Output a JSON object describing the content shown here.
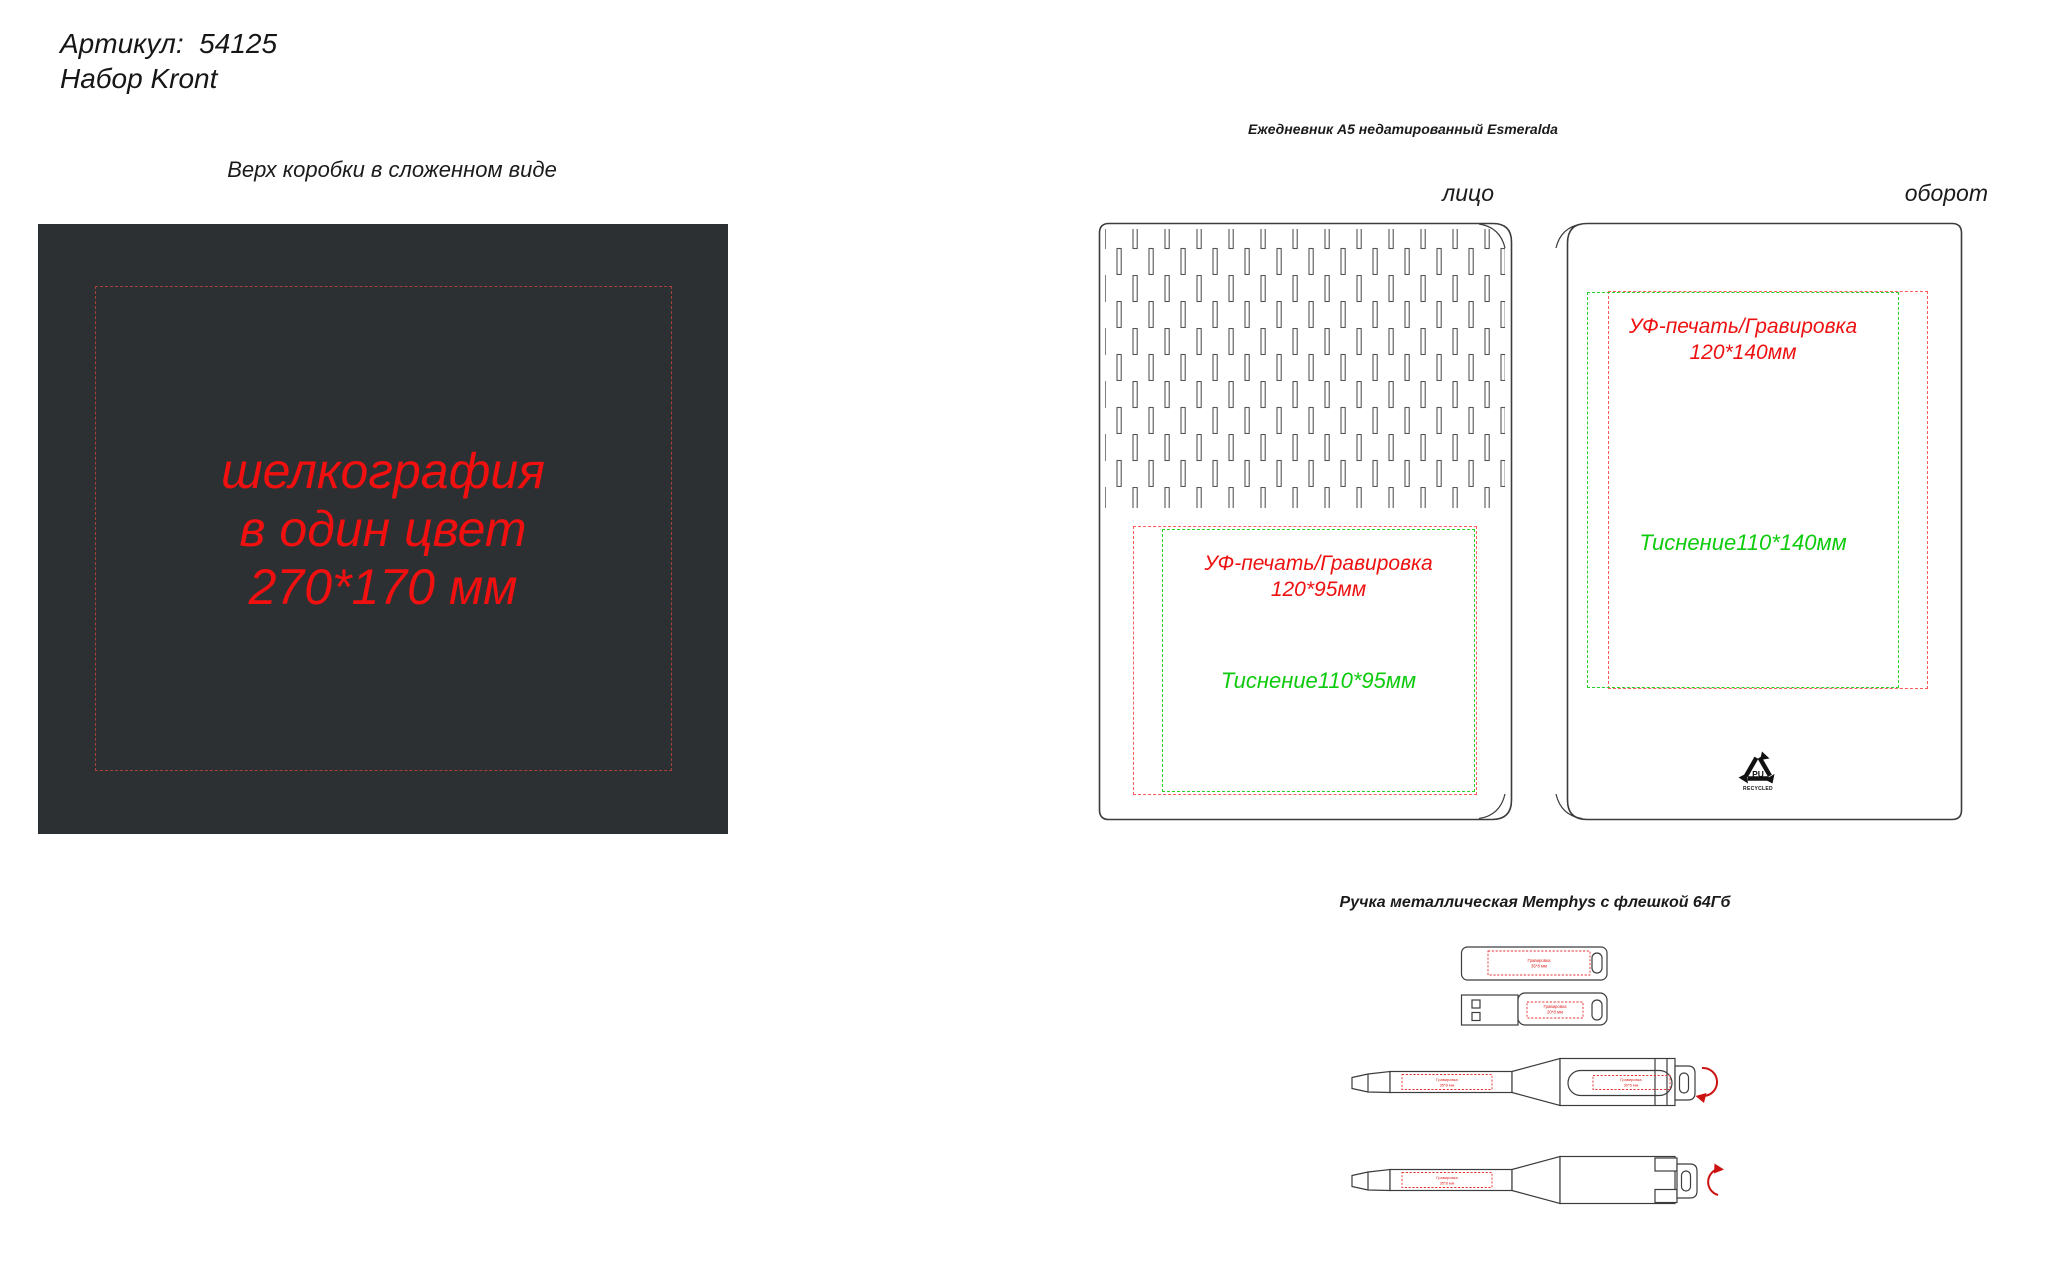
{
  "page": {
    "width": 2057,
    "height": 1277,
    "background": "#ffffff"
  },
  "header": {
    "article": "Артикул:  54125",
    "product": "Набор Kront"
  },
  "box_top": {
    "caption": "Верх коробки в сложенном виде",
    "fill_color": "#2d3032",
    "dash_color": "#a83f3a",
    "print_color": "#f01010",
    "print_note_lines": [
      "шелкография",
      "в один цвет",
      "270*170 мм"
    ]
  },
  "diary": {
    "caption": "Ежедневник А5 недатированный Esmeralda",
    "front_label": "лицо",
    "back_label": "оборот",
    "uv_color": "#ee1111",
    "emboss_color": "#0ecb0e",
    "front": {
      "uv_method": "УФ-печать/Гравировка",
      "uv_size": "120*95мм",
      "emboss_note": "Тиснение110*95мм"
    },
    "back": {
      "uv_method": "УФ-печать/Гравировка",
      "uv_size": "120*140мм",
      "emboss_note": "Тиснение110*140мм"
    },
    "recycle_mark": {
      "material": "PU",
      "caption": "RECYCLED"
    }
  },
  "pen": {
    "caption": "Ручка металлическая Memphys с флешкой 64Гб",
    "flash_top": {
      "line1": "Гравировка",
      "line2": "35*8 мм"
    },
    "flash_side": {
      "line1": "Гравировка",
      "line2": "20*8 мм"
    },
    "pen_front": {
      "barrel": {
        "line1": "Гравировка",
        "line2": "35*8 мм"
      },
      "clip": {
        "line1": "Гравировка",
        "line2": "30*5 мм"
      }
    },
    "pen_back": {
      "barrel": {
        "line1": "Гравировка",
        "line2": "35*8 мм"
      }
    }
  }
}
